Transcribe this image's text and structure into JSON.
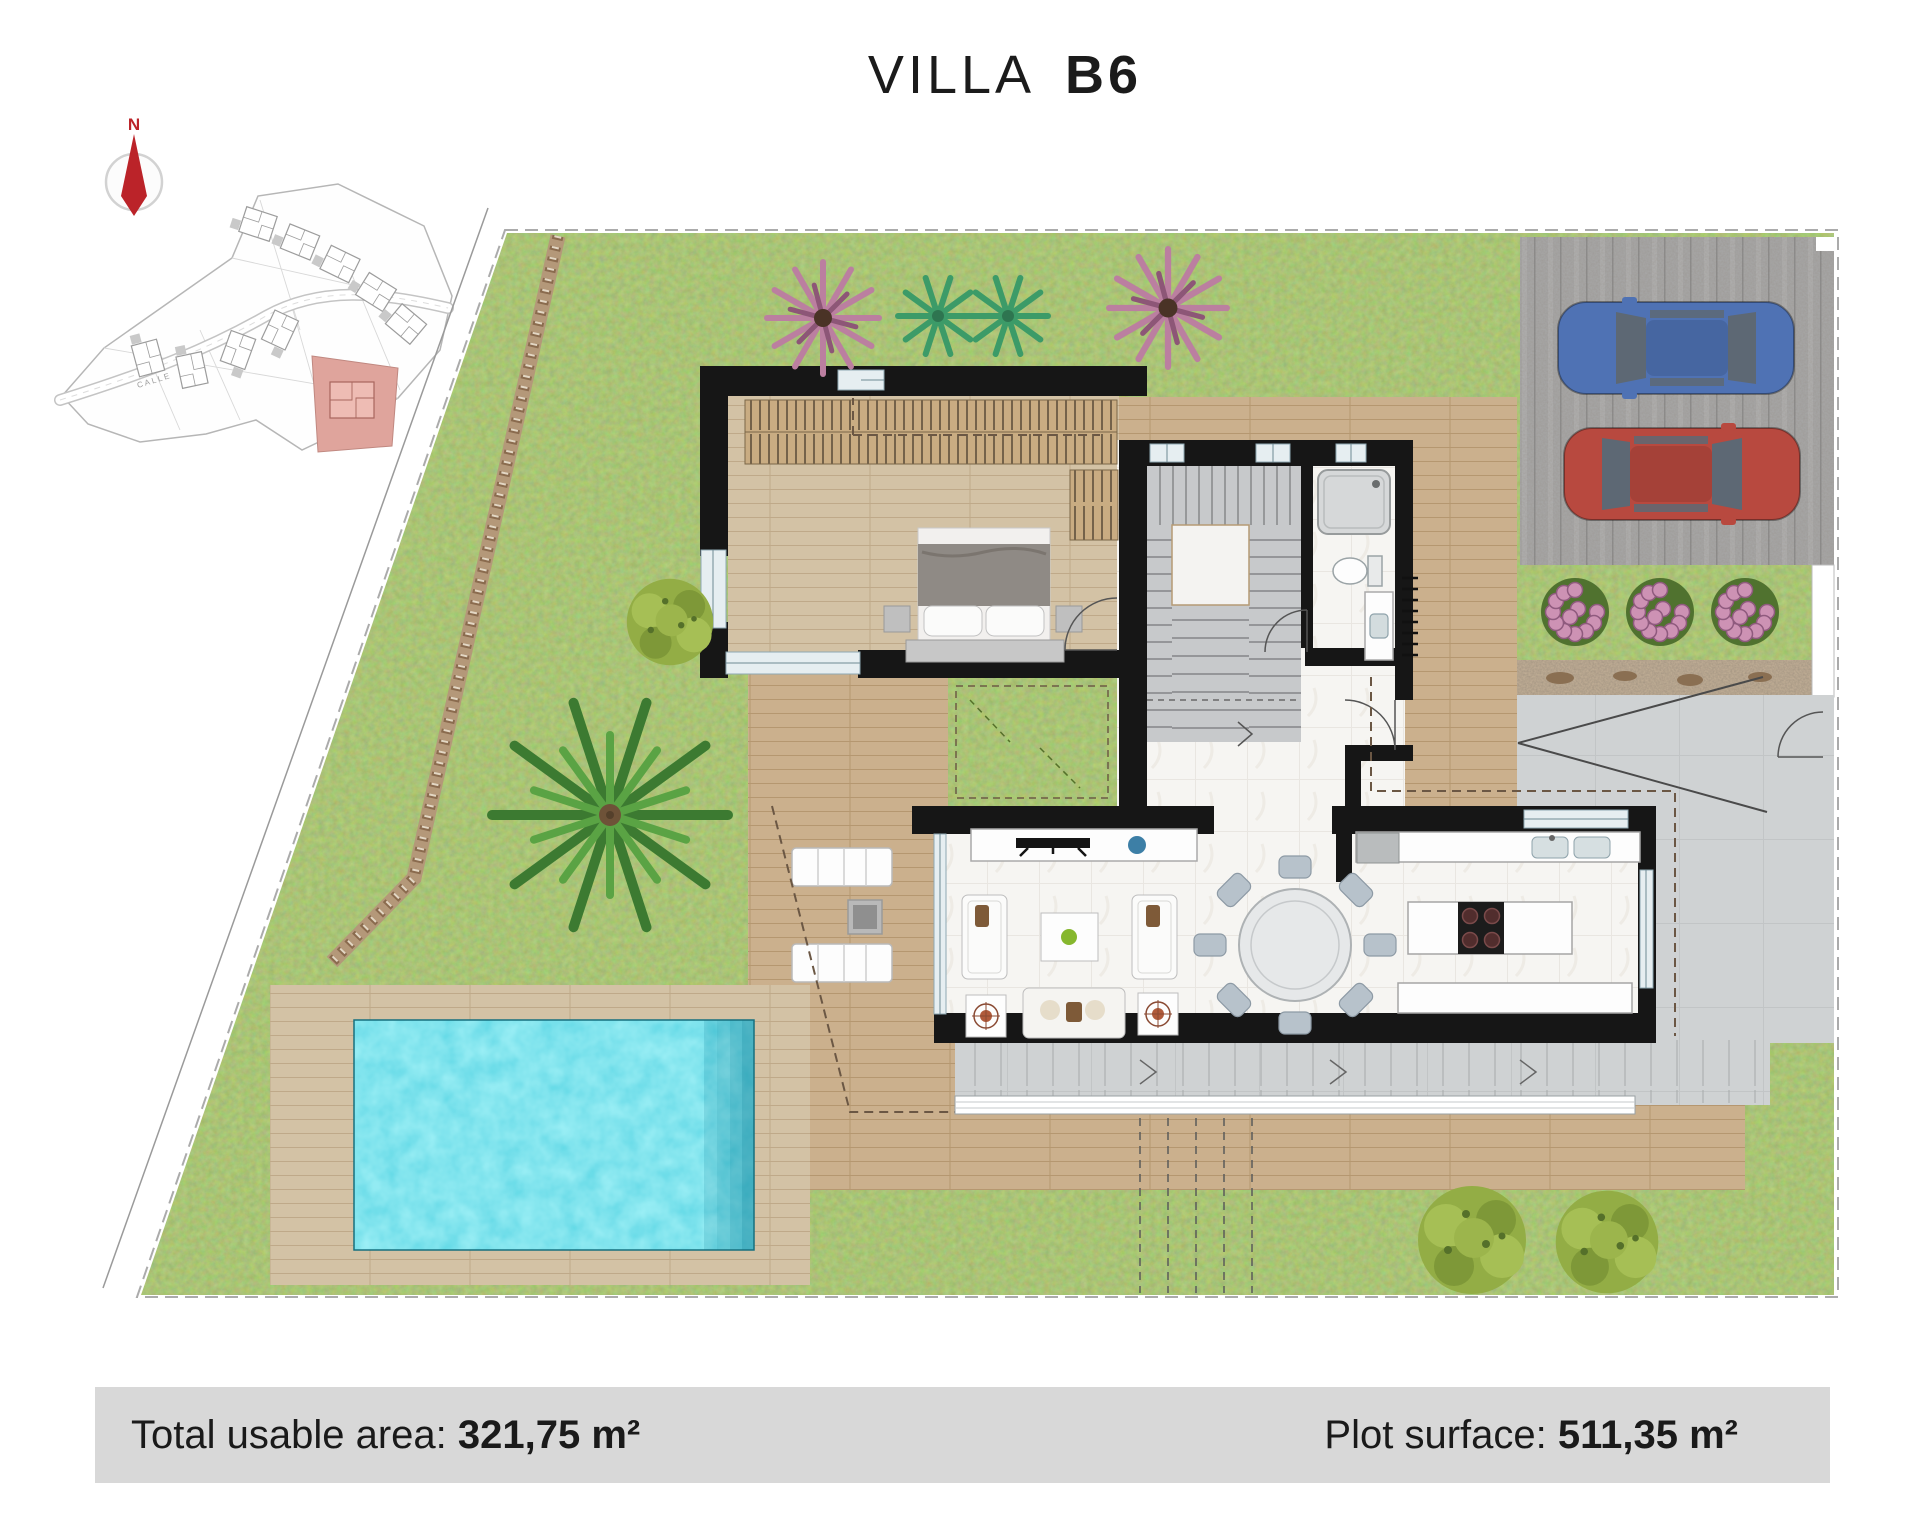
{
  "window": {
    "width": 1920,
    "height": 1521
  },
  "title": {
    "name": "VILLA",
    "unit": "B6"
  },
  "compass": {
    "label": "N"
  },
  "site_plan": {
    "road_label": "CALLE",
    "highlight_color": "#dfa49c"
  },
  "footer": {
    "left_label": "Total usable area: ",
    "left_value": "321,75 m²",
    "right_label": "Plot surface: ",
    "right_value": "511,35 m²"
  },
  "colors": {
    "grass": "#6c8e3f",
    "pool_water": "#35c2da",
    "deck_wood": "#cbb08d",
    "pool_deck_wood": "#d2c1a4",
    "parking_deck": "#a7a7a7",
    "concrete": "#cfd2d3",
    "wall_black": "#161616",
    "compass_red": "#bb2329",
    "car_blue": "#4f72b4",
    "car_red": "#b8493f",
    "flower_pink": "#cd92b4",
    "footer_bg": "#d8d8d8"
  }
}
